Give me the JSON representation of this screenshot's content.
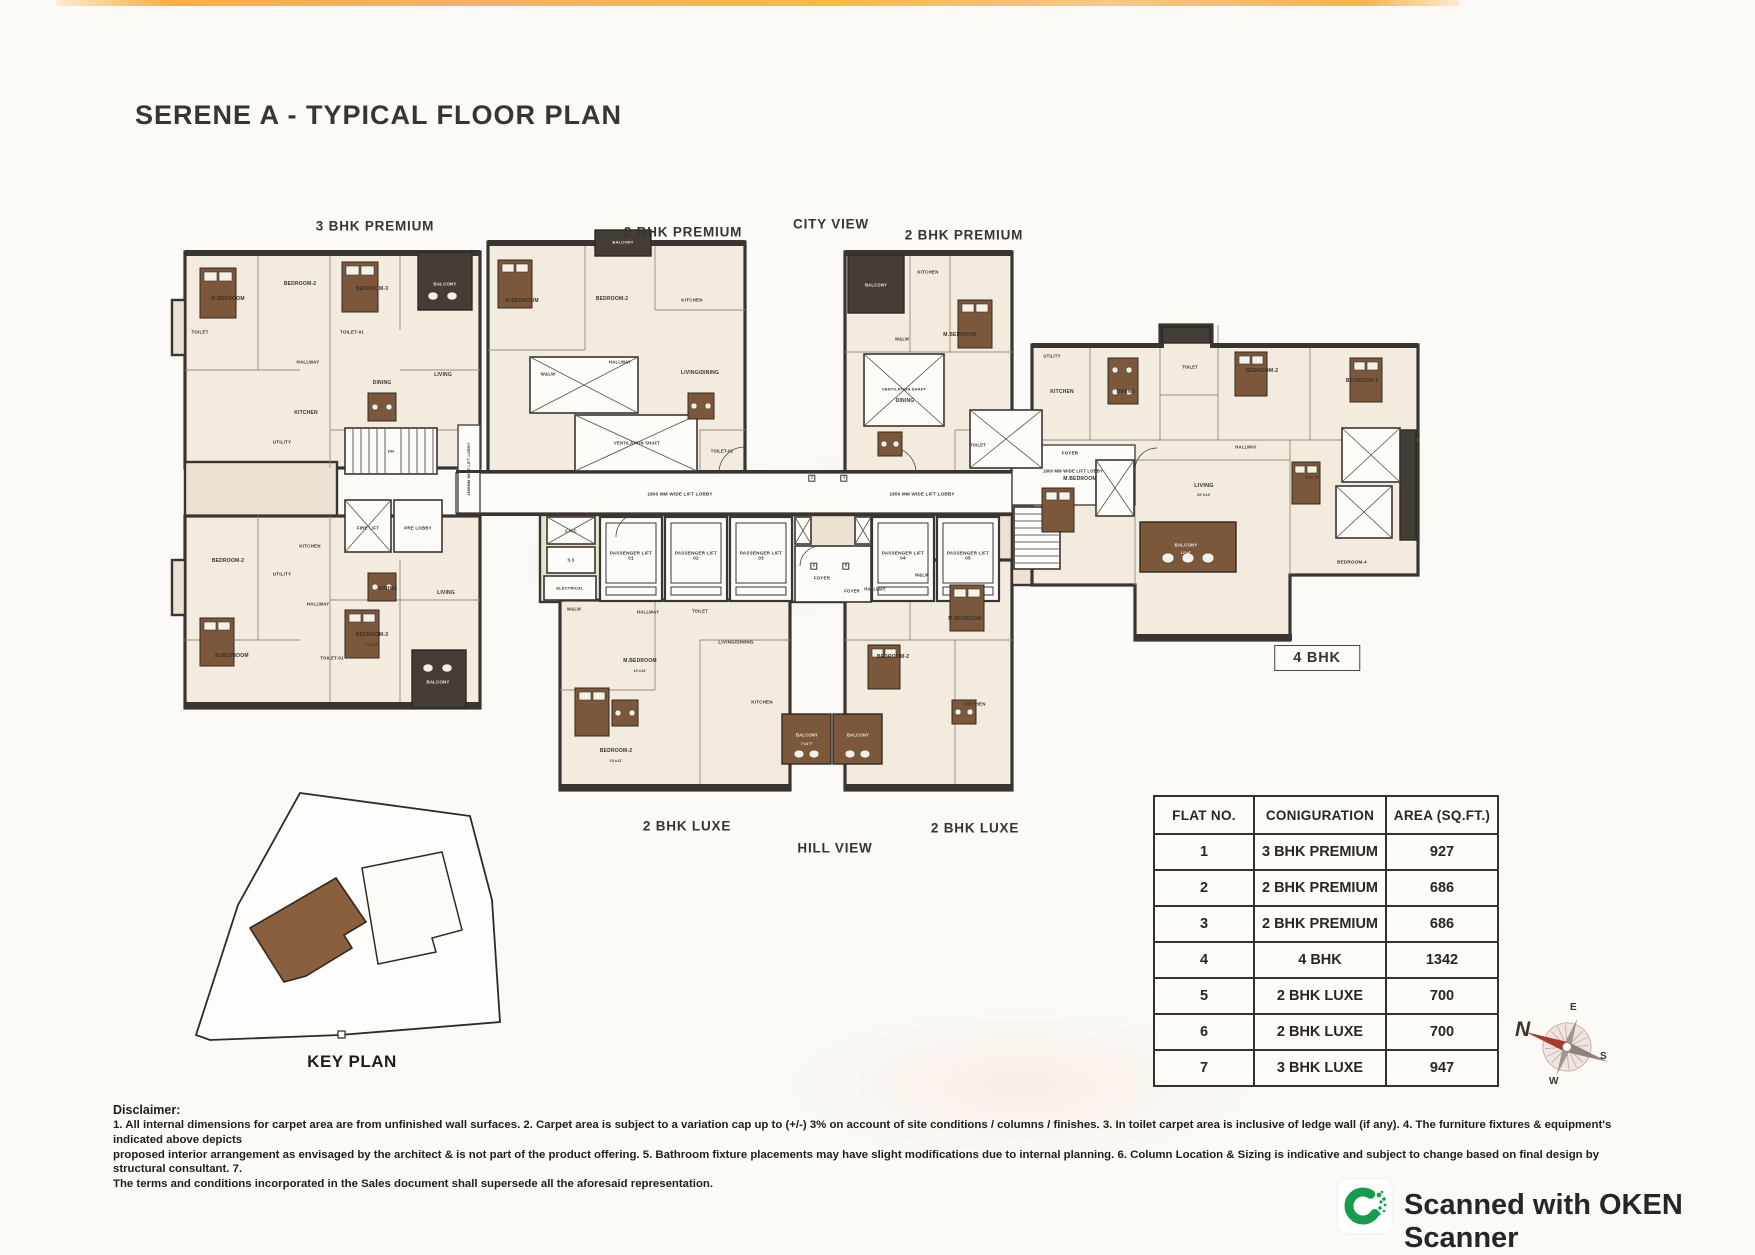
{
  "page": {
    "title": "SERENE A - TYPICAL FLOOR PLAN"
  },
  "colors": {
    "paper": "#fbfaf6",
    "ink": "#39332e",
    "wall": "#3b3531",
    "room_fill": "#f2ebde",
    "balcony_brown": "#7b583c",
    "table_border": "#353029",
    "scanner_green": "#169b4f",
    "compass_red": "#a8392b"
  },
  "floorplan": {
    "annotations": [
      {
        "id": "unit-label-3bhk-premium",
        "t": "3 BHK PREMIUM",
        "x": 375,
        "y": 226
      },
      {
        "id": "unit-label-2bhk-premium-1",
        "t": "2 BHK PREMIUM",
        "x": 683,
        "y": 232
      },
      {
        "id": "view-label-city",
        "t": "CITY VIEW",
        "x": 831,
        "y": 224
      },
      {
        "id": "unit-label-2bhk-premium-2",
        "t": "2 BHK PREMIUM",
        "x": 964,
        "y": 235
      },
      {
        "id": "unit-label-3bhk-luxe",
        "t": "3 BHK LUXE",
        "x": 350,
        "y": 823
      },
      {
        "id": "unit-label-2bhk-luxe-1",
        "t": "2 BHK LUXE",
        "x": 687,
        "y": 826
      },
      {
        "id": "view-label-hill",
        "t": "HILL VIEW",
        "x": 835,
        "y": 848
      },
      {
        "id": "unit-label-2bhk-luxe-2",
        "t": "2 BHK LUXE",
        "x": 975,
        "y": 828
      },
      {
        "id": "unit-label-4bhk",
        "t": "4 BHK",
        "x": 1317,
        "y": 658,
        "box": true
      }
    ],
    "labels": [
      {
        "t": "M.BEDROOM",
        "x": 228,
        "y": 300
      },
      {
        "t": "TOILET",
        "x": 200,
        "y": 332,
        "s": 4.5
      },
      {
        "t": "BEDROOM-2",
        "x": 300,
        "y": 285
      },
      {
        "t": "BEDROOM-3",
        "x": 372,
        "y": 290
      },
      {
        "t": "TOILET-01",
        "x": 352,
        "y": 332,
        "s": 4.5
      },
      {
        "t": "HALLWAY",
        "x": 308,
        "y": 362,
        "s": 4.5
      },
      {
        "t": "DINING",
        "x": 382,
        "y": 384
      },
      {
        "t": "LIVING",
        "x": 443,
        "y": 376
      },
      {
        "t": "KITCHEN",
        "x": 306,
        "y": 414
      },
      {
        "t": "UTILITY",
        "x": 282,
        "y": 442,
        "s": 4.5
      },
      {
        "t": "BALCONY",
        "x": 445,
        "y": 284,
        "c": "#f3ede2",
        "s": 4.4
      },
      {
        "t": "DN",
        "x": 391,
        "y": 452,
        "s": 4
      },
      {
        "t": "FIRE LIFT",
        "x": 368,
        "y": 528,
        "s": 4.4
      },
      {
        "t": "PRE LOBBY",
        "x": 418,
        "y": 528,
        "s": 4.4
      },
      {
        "t": "1800MM WIDE LIFT LOBBY",
        "x": 469,
        "y": 469,
        "s": 3.8,
        "r": -90
      },
      {
        "t": "BEDROOM-2",
        "x": 228,
        "y": 562
      },
      {
        "t": "KITCHEN",
        "x": 310,
        "y": 546,
        "s": 4.5
      },
      {
        "t": "UTILITY",
        "x": 282,
        "y": 574,
        "s": 4.5
      },
      {
        "t": "DINING",
        "x": 388,
        "y": 590
      },
      {
        "t": "LIVING",
        "x": 446,
        "y": 594
      },
      {
        "t": "M.BEDROOM",
        "x": 232,
        "y": 657
      },
      {
        "t": "BEDROOM-3",
        "x": 372,
        "y": 636
      },
      {
        "t": "10'x11'",
        "x": 372,
        "y": 645,
        "s": 3.6
      },
      {
        "t": "TOILET-01",
        "x": 332,
        "y": 658,
        "s": 4.4
      },
      {
        "t": "HALLWAY",
        "x": 318,
        "y": 604,
        "s": 4.4
      },
      {
        "t": "BALCONY",
        "x": 438,
        "y": 682,
        "c": "#f3ede2",
        "s": 4.4
      },
      {
        "t": "M.BEDROOM",
        "x": 522,
        "y": 302
      },
      {
        "t": "BEDROOM-2",
        "x": 612,
        "y": 300
      },
      {
        "t": "W&LW",
        "x": 548,
        "y": 374,
        "s": 4.4
      },
      {
        "t": "HALLWAY",
        "x": 620,
        "y": 362,
        "s": 4.4
      },
      {
        "t": "KITCHEN",
        "x": 692,
        "y": 300,
        "s": 4.5
      },
      {
        "t": "LIVING/DINING",
        "x": 700,
        "y": 374
      },
      {
        "t": "TOILET-01",
        "x": 722,
        "y": 452,
        "s": 4.2
      },
      {
        "t": "VENTILATION SHAFT",
        "x": 637,
        "y": 444,
        "s": 4.2
      },
      {
        "t": "BALCONY",
        "x": 623,
        "y": 243,
        "c": "#f3ede2",
        "s": 4
      },
      {
        "t": "BALCONY",
        "x": 876,
        "y": 286,
        "c": "#f3ede2",
        "s": 4.2
      },
      {
        "t": "KITCHEN",
        "x": 928,
        "y": 272,
        "s": 4.5
      },
      {
        "t": "M.BEDROOM",
        "x": 960,
        "y": 336
      },
      {
        "t": "W&LW",
        "x": 902,
        "y": 340,
        "s": 4.2
      },
      {
        "t": "DINING",
        "x": 905,
        "y": 402
      },
      {
        "t": "TOILET",
        "x": 978,
        "y": 446,
        "s": 4.2
      },
      {
        "t": "VENTILATION SHAFT",
        "x": 904,
        "y": 390,
        "s": 4
      },
      {
        "t": "1800 MM WIDE LIFT LOBBY",
        "x": 680,
        "y": 494,
        "s": 4.6
      },
      {
        "t": "1800 MM WIDE LIFT LOBBY",
        "x": 922,
        "y": 494,
        "s": 4.6
      },
      {
        "t": "1800 MM WIDE LIFT LOBBY",
        "x": 1073,
        "y": 472,
        "s": 4.2
      },
      {
        "t": "F.H.C",
        "x": 571,
        "y": 532,
        "s": 4.2
      },
      {
        "t": "S.S",
        "x": 571,
        "y": 561,
        "s": 4.2
      },
      {
        "t": "ELECTRICAL",
        "x": 570,
        "y": 589,
        "s": 4
      },
      {
        "t": "PASSENGER LIFT 01",
        "x": 631,
        "y": 556,
        "s": 4.6,
        "w": 44
      },
      {
        "t": "PASSENGER LIFT 02",
        "x": 696,
        "y": 556,
        "s": 4.6,
        "w": 44
      },
      {
        "t": "PASSENGER LIFT 03",
        "x": 761,
        "y": 556,
        "s": 4.6,
        "w": 44
      },
      {
        "t": "PASSENGER LIFT 04",
        "x": 903,
        "y": 556,
        "s": 4.6,
        "w": 44
      },
      {
        "t": "PASSENGER LIFT 05",
        "x": 968,
        "y": 556,
        "s": 4.6,
        "w": 44
      },
      {
        "t": "FOYER",
        "x": 822,
        "y": 578,
        "s": 4.4
      },
      {
        "t": "FOYER",
        "x": 852,
        "y": 592,
        "s": 4.2
      },
      {
        "t": "2",
        "x": 812,
        "y": 478,
        "s": 4,
        "box": true
      },
      {
        "t": "3",
        "x": 844,
        "y": 478,
        "s": 4,
        "box": true
      },
      {
        "t": "6",
        "x": 814,
        "y": 566,
        "s": 4,
        "box": true
      },
      {
        "t": "5",
        "x": 846,
        "y": 566,
        "s": 4,
        "box": true
      },
      {
        "t": "W&LW",
        "x": 574,
        "y": 610,
        "s": 4.2
      },
      {
        "t": "HALLWAY",
        "x": 648,
        "y": 612,
        "s": 4.4
      },
      {
        "t": "M.BEDROOM",
        "x": 640,
        "y": 662
      },
      {
        "t": "10'x12'",
        "x": 640,
        "y": 671,
        "s": 3.6
      },
      {
        "t": "BEDROOM-2",
        "x": 616,
        "y": 752
      },
      {
        "t": "10'x11'",
        "x": 616,
        "y": 761,
        "s": 3.6
      },
      {
        "t": "KITCHEN",
        "x": 762,
        "y": 702,
        "s": 4.5
      },
      {
        "t": "LIVING/DINING",
        "x": 736,
        "y": 642,
        "s": 4.6
      },
      {
        "t": "TOILET",
        "x": 700,
        "y": 612,
        "s": 4.2
      },
      {
        "t": "BALCONY",
        "x": 807,
        "y": 736,
        "c": "#f3ede2",
        "s": 4.2
      },
      {
        "t": "7'x3'7\"",
        "x": 807,
        "y": 744,
        "c": "#f3ede2",
        "s": 3.5
      },
      {
        "t": "BALCONY",
        "x": 858,
        "y": 736,
        "c": "#f3ede2",
        "s": 4.2
      },
      {
        "t": "HALLWAY",
        "x": 875,
        "y": 590,
        "s": 4.2
      },
      {
        "t": "W&LW",
        "x": 922,
        "y": 576,
        "s": 4.2
      },
      {
        "t": "M.BEDROOM",
        "x": 965,
        "y": 620
      },
      {
        "t": "BEDROOM-2",
        "x": 893,
        "y": 658
      },
      {
        "t": "KITCHEN",
        "x": 975,
        "y": 704,
        "s": 4.5
      },
      {
        "t": "UTILITY",
        "x": 1052,
        "y": 357,
        "s": 4.2
      },
      {
        "t": "KITCHEN",
        "x": 1062,
        "y": 393
      },
      {
        "t": "FOYER",
        "x": 1070,
        "y": 453,
        "s": 4.5
      },
      {
        "t": "DINING",
        "x": 1126,
        "y": 393
      },
      {
        "t": "TOILET",
        "x": 1190,
        "y": 368,
        "s": 4.2
      },
      {
        "t": "BEDROOM-2",
        "x": 1262,
        "y": 372
      },
      {
        "t": "BEDROOM-3",
        "x": 1362,
        "y": 382
      },
      {
        "t": "M.BEDROOM",
        "x": 1080,
        "y": 480
      },
      {
        "t": "LIVING",
        "x": 1204,
        "y": 486,
        "s": 5.5
      },
      {
        "t": "20'x13'",
        "x": 1204,
        "y": 495,
        "s": 3.8
      },
      {
        "t": "BALCONY",
        "x": 1186,
        "y": 545,
        "c": "#f3ede2",
        "s": 4.4
      },
      {
        "t": "12'x8'",
        "x": 1186,
        "y": 553,
        "c": "#f3ede2",
        "s": 3.5
      },
      {
        "t": "HALLWAY",
        "x": 1246,
        "y": 448,
        "s": 4.2
      },
      {
        "t": "BEDROOM-4",
        "x": 1352,
        "y": 562,
        "s": 4.6
      },
      {
        "t": "W&LW",
        "x": 1312,
        "y": 478,
        "s": 4
      }
    ]
  },
  "table": {
    "headers": [
      "FLAT NO.",
      "CONIGURATION",
      "AREA (SQ.FT.)"
    ],
    "rows": [
      [
        "1",
        "3 BHK PREMIUM",
        "927"
      ],
      [
        "2",
        "2 BHK PREMIUM",
        "686"
      ],
      [
        "3",
        "2 BHK PREMIUM",
        "686"
      ],
      [
        "4",
        "4 BHK",
        "1342"
      ],
      [
        "5",
        "2 BHK LUXE",
        "700"
      ],
      [
        "6",
        "2 BHK  LUXE",
        "700"
      ],
      [
        "7",
        "3 BHK  LUXE",
        "947"
      ]
    ]
  },
  "key_plan": {
    "label": "KEY PLAN"
  },
  "compass": {
    "n": "N",
    "e": "E",
    "s": "S",
    "w": "W"
  },
  "disclaimer": {
    "heading": "Disclaimer:",
    "lines": [
      "1. All internal dimensions for carpet area are from unfinished wall surfaces. 2. Carpet area is subject to a variation cap up to (+/-) 3% on account of site conditions / columns / finishes. 3. In toilet carpet area is inclusive of ledge wall (if any). 4. The furniture fixtures & equipment's indicated above depicts",
      "proposed interior arrangement as envisaged by the architect & is not part of the product offering. 5. Bathroom fixture placements may have slight modifications due to internal planning. 6. Column Location & Sizing is indicative and subject to change based on final design by structural consultant. 7.",
      "The terms and conditions incorporated in the Sales document shall supersede all the aforesaid representation."
    ]
  },
  "footer": {
    "scanner_text": "Scanned with OKEN Scanner"
  }
}
